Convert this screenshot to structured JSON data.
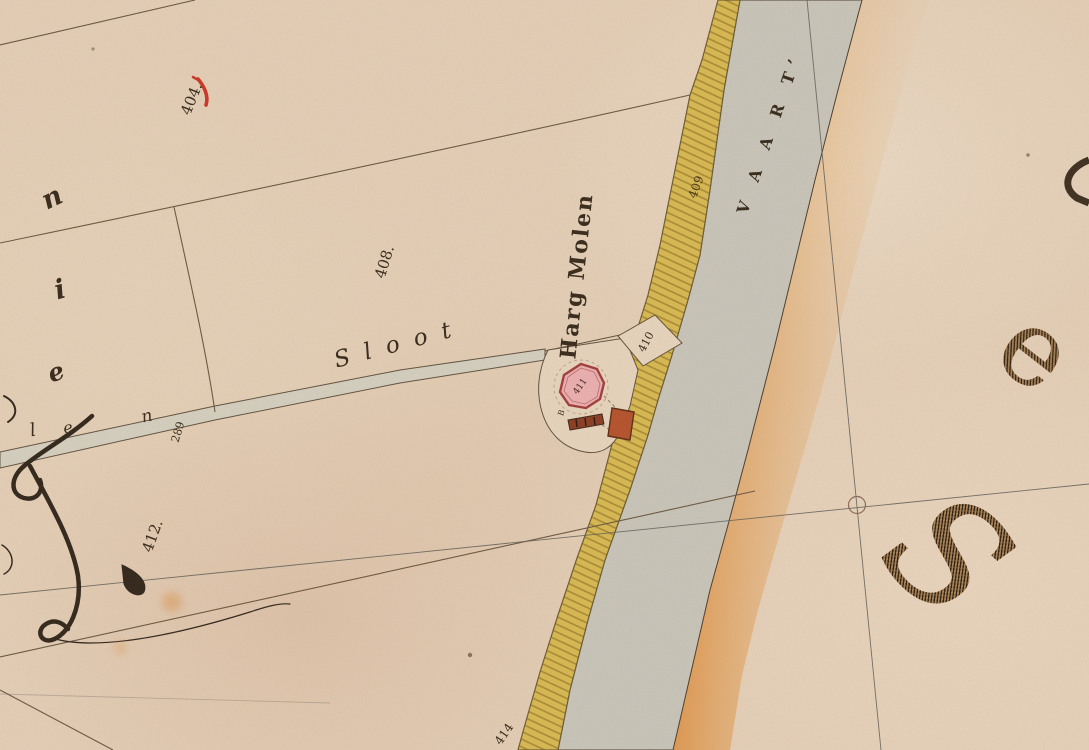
{
  "map": {
    "title": "Historical cadastral map detail — Harg Molen at the Vaart",
    "region_labels": {
      "vaart": "V A A R T’",
      "sloot": "Sloot",
      "mill": "Harg Molen"
    },
    "parcel_numbers": {
      "p404": "404.",
      "p408": "408.",
      "p409": "409",
      "p410": "410",
      "p411": "411",
      "p412": "412.",
      "p414": "414",
      "p289": "289"
    },
    "edge_letters": {
      "left_top": "n",
      "left_middle": "i",
      "left_bottom": "e",
      "low_l": "l",
      "low_e": "e",
      "low_n": "n"
    },
    "big_letters": {
      "upper_right": "e",
      "lower_right": "S"
    },
    "annotations": {
      "mill_mark": "B"
    },
    "colors": {
      "paper": "#e6d0b8",
      "water": "#c9c6bb",
      "dike_yellow": "#d9ba50",
      "dike_hatch": "#8a6a1e",
      "bank_orange": "#d96f12",
      "mill_pink": "#edb0b2",
      "mill_outline": "#a03a3a",
      "building_red": "#8a3a20",
      "building_red2": "#b5502a",
      "ink": "#3c2f20",
      "boundary_sepia": "#6a5640",
      "survey_line": "#5a5a55",
      "check_red": "#cc3322"
    }
  }
}
